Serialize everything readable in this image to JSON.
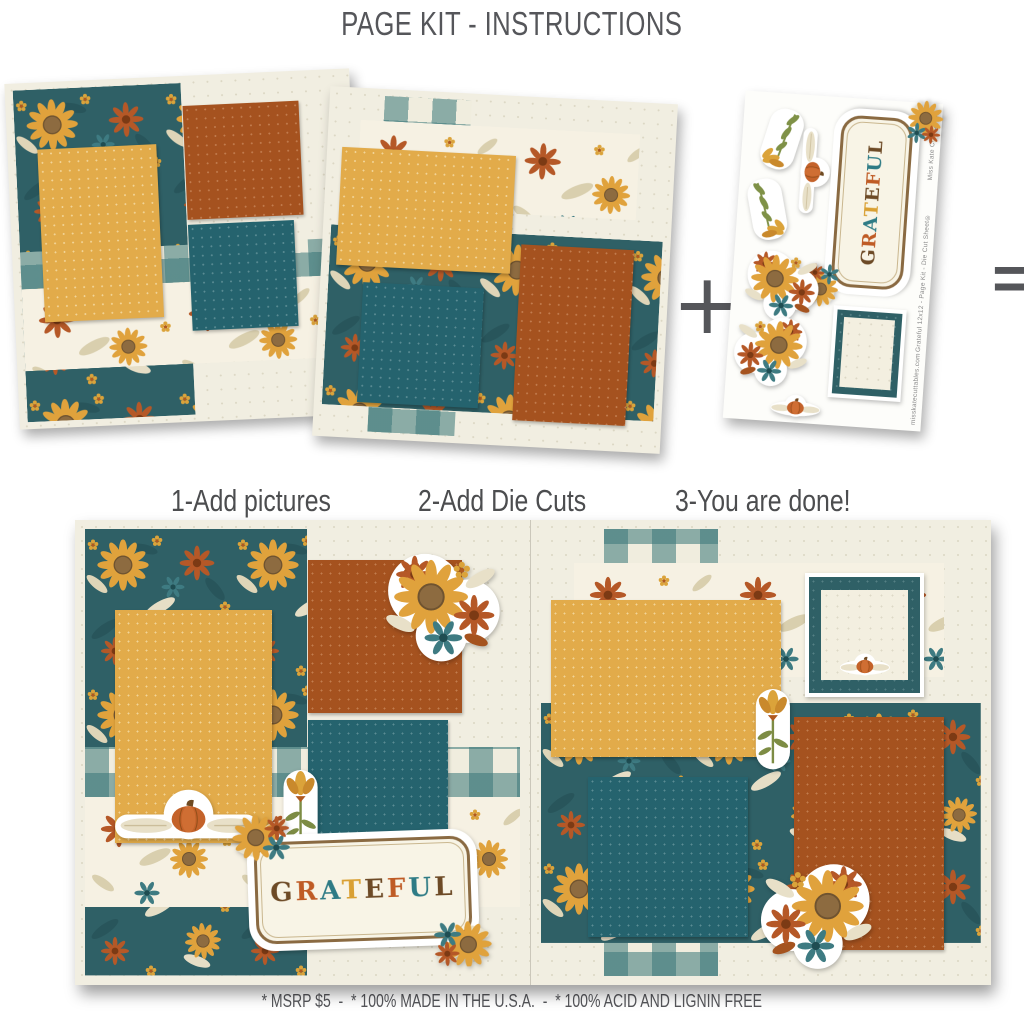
{
  "title": "PAGE KIT - INSTRUCTIONS",
  "operators": {
    "plus": "+",
    "equals": "="
  },
  "steps": {
    "step1": "1-Add pictures",
    "step2": "2-Add Die Cuts",
    "step3": "3-You are done!"
  },
  "footer": "* MSRP $5  -  * 100% MADE IN THE U.S.A.  -  * 100% ACID AND LIGNIN FREE",
  "die_cut_sheet": {
    "side_brand": "Miss Kate Cuttables™",
    "side_product": "Grateful 12x12 - Page Kit - Die Cut Sheet®",
    "side_url": "misskatecuttables.com"
  },
  "grateful": {
    "word": "GRATEFUL",
    "letter_colors": [
      "#6d4a26",
      "#bf5b25",
      "#2e7b85",
      "#d9a033",
      "#6d4a26",
      "#bf5b25",
      "#2e7b85",
      "#6d4a26"
    ]
  },
  "colors": {
    "floral_teal_paper": "#2f6066",
    "mat_gold": "#e2ab4a",
    "mat_rust": "#a5521f",
    "mat_teal": "#25636e",
    "cream_paper": "#f1eee1",
    "gingham_teal": "#387678",
    "text_gray": "#55565a",
    "label_border_brown": "#8a6a42"
  }
}
